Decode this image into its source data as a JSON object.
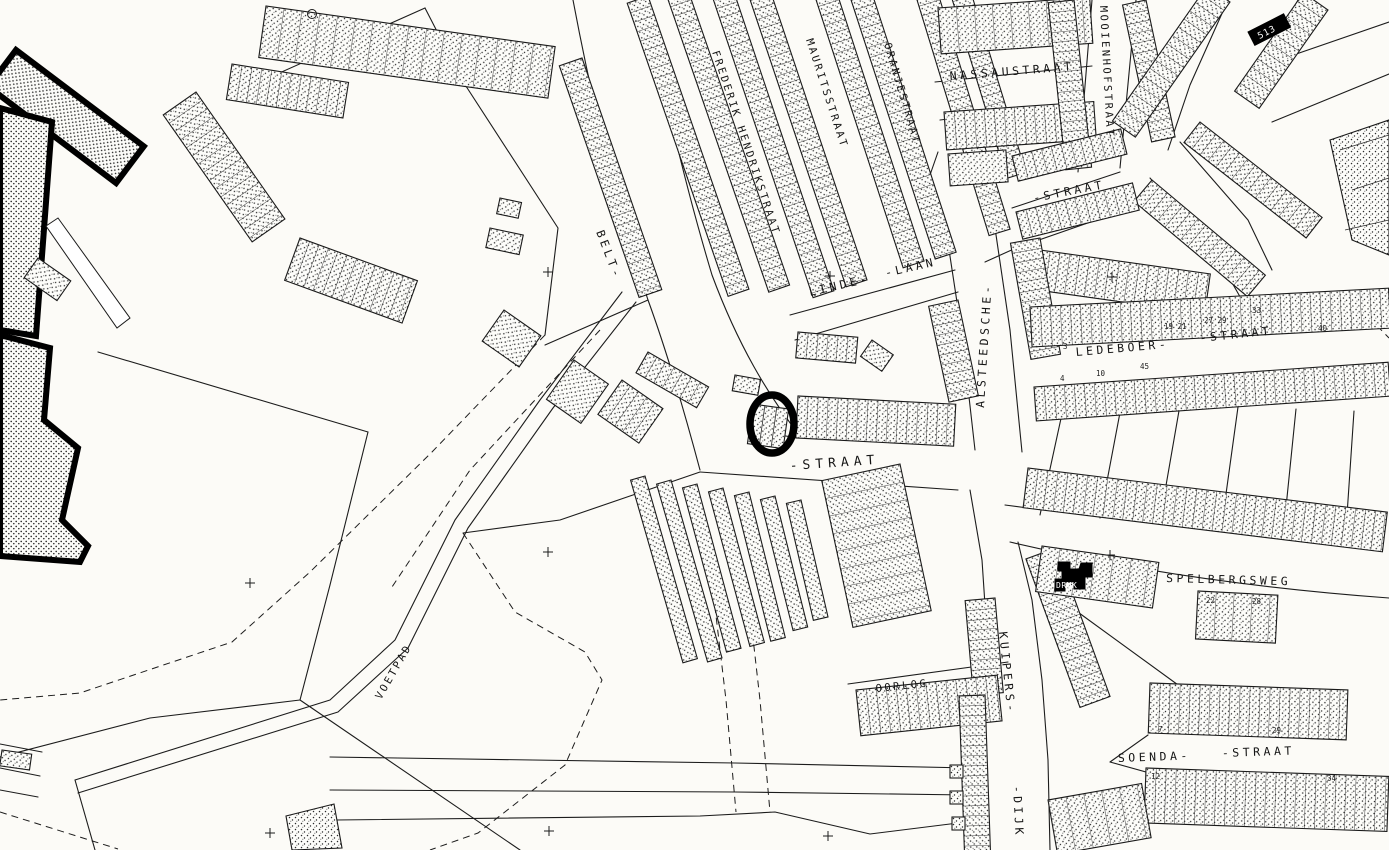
{
  "map": {
    "street_labels": {
      "frederik_hendrikstraat": "FREDERIK HENDRIKSTRAAT",
      "mauritsstraat": "MAURITSSTRAAT",
      "oranjestraat": "ORANJESTRAAT",
      "nassaustraat": "NASSAUSTRAAT",
      "mooienhofstraat": "MOOIENHOFSTRAAT",
      "straat_topright": "-STRAAT",
      "linde": "LINDE-",
      "laan": "-LAAN",
      "alsteedsche": "ALSTEEDSCHE-",
      "ledeboer": "LEDEBOER-",
      "ledeboer_straat": "-STRAAT",
      "belt": "BELT-",
      "straat_center": "-STRAAT",
      "voetpad": "VOETPAD",
      "spelbergsweg": "SPELBERGSWEG",
      "kuipers": "KUIPERS-",
      "dijk": "-DIJK",
      "oorlog": "OORLOG",
      "soenda": "SOENDA-",
      "soenda_straat": "-STRAAT"
    },
    "building_labels": {
      "black_parcel": "513",
      "druk": "DRUK"
    },
    "house_numbers": [
      {
        "t": "3"
      },
      {
        "t": "19 21"
      },
      {
        "t": "27 29"
      },
      {
        "t": "33"
      },
      {
        "t": "40"
      },
      {
        "t": "4"
      },
      {
        "t": "10"
      },
      {
        "t": "45"
      },
      {
        "t": "22"
      },
      {
        "t": "28"
      },
      {
        "t": "7"
      },
      {
        "t": "29"
      },
      {
        "t": "12"
      },
      {
        "t": "34"
      }
    ],
    "annotation": {
      "type": "circle-highlight"
    },
    "colors": {
      "ink": "#1a1a1a",
      "paper": "#fcfbf7"
    }
  }
}
